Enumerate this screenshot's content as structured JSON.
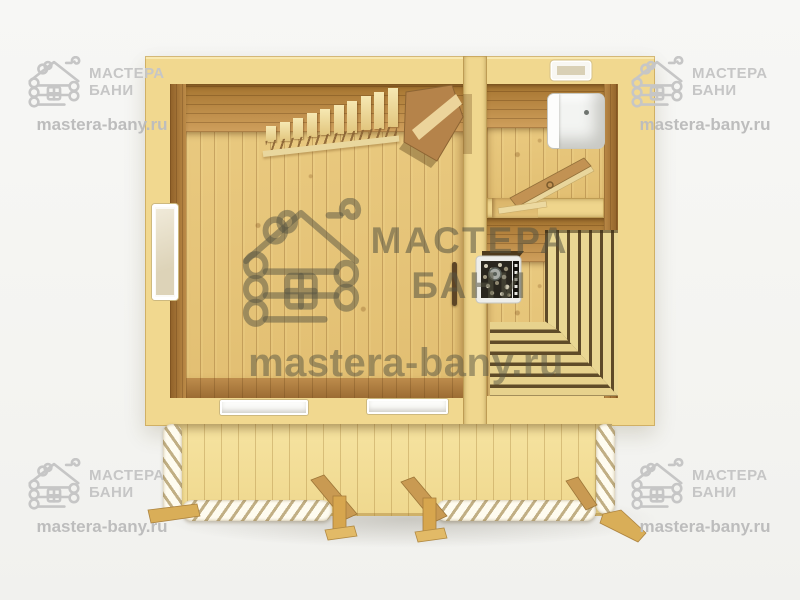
{
  "meta": {
    "description": "Top-down 3D cutaway floor plan render of a wooden bath house (banya) with main room, washroom and sauna"
  },
  "watermark": {
    "brand_line1": "МАСТЕРА",
    "brand_line2": "БАНИ",
    "url": "mastera-bany.ru",
    "icon": "log-cabin-icon",
    "corner_color": "#c6c6c6",
    "center_color": "rgba(86,84,66,0.55)"
  },
  "palette": {
    "background": "#f5f5f2",
    "wall_cut_surface": "#f1d88f",
    "wall_inner_face": "#b5823f",
    "floor_light": "#e9c97f",
    "floor_stripe": "#c89455",
    "bench_dark": "#5f4b28",
    "bench_light": "#e7d28d",
    "fixture_white": "#f3f4f2",
    "stove_stones_dark": "#29261e"
  },
  "plan": {
    "elements": [
      "staircase-top-view",
      "stair-railing",
      "main-room-door-open",
      "washroom-door-open",
      "window-left-wall",
      "window-bottom-1",
      "window-bottom-2",
      "window-top-wall",
      "shower-tray",
      "sauna-stove-with-stones",
      "stove-chimney-pipe",
      "sauna-bench-slats",
      "sauna-corner-step-benches",
      "facade-plank-wall",
      "carved-rope-logs",
      "diagonal-braces",
      "support-posts"
    ]
  }
}
